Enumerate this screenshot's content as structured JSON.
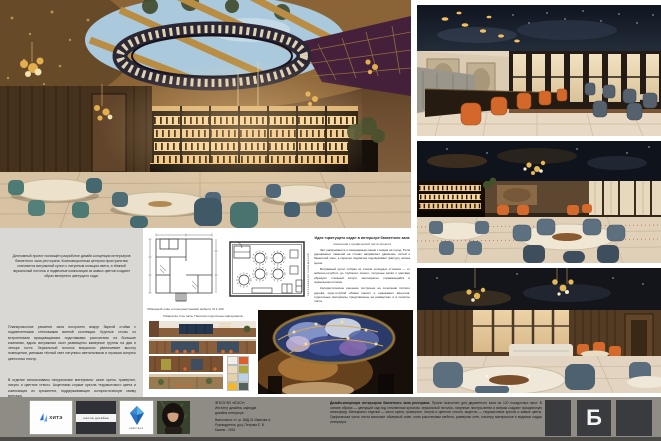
{
  "board": {
    "sheet_letter": "Б"
  },
  "colors": {
    "accent_orange": "#d4682a",
    "chair_teal": "#4d7a72",
    "chair_slate": "#55616e",
    "ceiling_navy": "#10151f",
    "brass_gold": "#d8ab57",
    "panel_grey": "#d9d8d5",
    "footer_bar": "#8f8c86"
  },
  "left_panel": {
    "intro": "Дипломный проект посвящён разработке дизайн-концепции интерьеров банкетного зала ресторана. Композиционным центром пространства становится витражный купол с латунным кольцом света, а тёмный зеркальный потолок и подвесные композиции из живых цветов создают образ вечернего цветущего сада.",
    "paragraph_1": "Планировочное решение зала построено вокруг барной стойки с подсвеченными стеллажами винной коллекции. Круглые столы со встроенными вращающимися подставками рассчитаны на большие компании, вдоль витражных окон размещены камерные группы на два и четыре гостя. Зеркальный потолок визуально увеличивает высоту помещения, умножая тёплый свет латунных светильников и отражая силуэты цветочных люстр.",
    "paragraph_2": "В отделке использованы натуральные материалы: шпон ореха, травертин, латунь и цветное стекло. Акцентами служат кресла терракотового цвета и композиции из хризантем, поддерживающие колористическую гамму витража."
  },
  "plans": {
    "caption": "Обмерный план и план расстановки мебели. М 1:100",
    "side_label": "экспликация помещений"
  },
  "note_block": {
    "heading_line1": "Идея «цветущего сада» в интерьере банкетного зала",
    "heading_line2": "пояснения к графической части проекта",
    "paragraph_1": "Зал раскрывается к панорамным окнам с видом на город. Ритм деревянных ламелей на стенах направляет движение гостей к банкетной зоне, а скрытая подсветка подчёркивает фактуру шпона ореха.",
    "paragraph_2": "Витражный купол собран из стекла холодных оттенков — от небесно-голубого до глубокого синего; латунные ветви с цветами образуют сложный силуэт, многократно отражающийся в зеркальном потолке.",
    "paragraph_3": "Колористическое решение построено на сочетании тёплого дерева, серо-голубой обивки кресел и оранжевых акцентов; отделочные материалы представлены на развертках и в палитре листа."
  },
  "palette": {
    "caption": "Развертки стен зала. Палитра отделочных материалов",
    "swatches": [
      "#f1eee8",
      "#dd5f2a",
      "#ead9bb",
      "#b1a63e",
      "#e6d0a9",
      "#b9d2e6",
      "#f1b82e",
      "#55625b"
    ]
  },
  "footer": {
    "logo1_text": "ХИТЭ",
    "logo2_text": "школа дизайна",
    "logo3_text": "кристалл",
    "credits_lines": [
      "ФГБОУ ВО «КГАСУ»",
      "Институт дизайна, кафедра",
      "дизайна интерьера",
      "Выполнила: ст. гр. 8ИД-01 Иванова А.",
      "Руководитель: доц. Петрова Е. В.",
      "Казань · 2024"
    ],
    "annotation_lead": "Дизайн-концепция интерьеров банкетного зала ресторана.",
    "annotation_body": "Проект выполнен для двусветного зала на 120 посадочных мест. В основе образа — цветущий сад под стеклянным куполом: зеркальный потолок, латунные люстры-ветви и витраж создают праздничную атмосферу. Материалы отделки — шпон ореха, травертин, латунь и цветное стекло; акценты — терракотовые кресла и живые цветы. Графическая часть листа включает обмерный план, план расстановки мебели, развертки стен, палитру материалов и видовые кадры интерьера."
  }
}
